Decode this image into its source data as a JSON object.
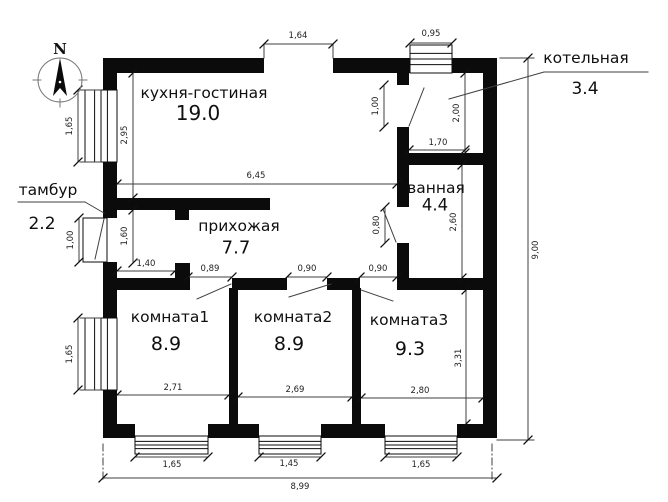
{
  "style": {
    "background": "#ffffff",
    "wall_color": "#0b0b0b",
    "line_color": "#3f3f3f",
    "tick_color": "#111111",
    "text_color": "#1f1f1f"
  },
  "compass": {
    "label": "N",
    "cx": 60,
    "cy": 80,
    "r": 22
  },
  "rooms": [
    {
      "name": "кухня-гостиная",
      "area": "19.0",
      "nx": 204,
      "ny": 93,
      "ax": 198,
      "ay": 113,
      "nfs": 15.5,
      "afs": 20
    },
    {
      "name": "прихожая",
      "area": "7.7",
      "nx": 239,
      "ny": 226,
      "ax": 236,
      "ay": 248,
      "nfs": 15.5,
      "afs": 18
    },
    {
      "name": "ванная",
      "area": "4.4",
      "nx": 436,
      "ny": 188,
      "ax": 435,
      "ay": 205,
      "nfs": 15.5,
      "afs": 16.5
    },
    {
      "name": "комната1",
      "area": "8.9",
      "nx": 170,
      "ny": 317,
      "ax": 166,
      "ay": 344,
      "nfs": 15.5,
      "afs": 19
    },
    {
      "name": "комната2",
      "area": "8.9",
      "nx": 293,
      "ny": 317,
      "ax": 289,
      "ay": 344,
      "nfs": 15.5,
      "afs": 19
    },
    {
      "name": "комната3",
      "area": "9.3",
      "nx": 409,
      "ny": 320,
      "ax": 410,
      "ay": 349,
      "nfs": 15.5,
      "afs": 19
    },
    {
      "name": "котельная",
      "area": "3.4",
      "nx": 586,
      "ny": 58,
      "ax": 585,
      "ay": 89,
      "nfs": 15.5,
      "afs": 17
    },
    {
      "name": "тамбур",
      "area": "2.2",
      "nx": 48,
      "ny": 190,
      "ax": 42,
      "ay": 224,
      "nfs": 15.5,
      "afs": 17
    }
  ],
  "dimensions": [
    {
      "t": "1,64",
      "x1": 264,
      "y1": 44,
      "x2": 333,
      "y2": 44,
      "tx": 298,
      "ty": 36,
      "r": 0
    },
    {
      "t": "0,95",
      "x1": 410,
      "y1": 43,
      "x2": 452,
      "y2": 43,
      "tx": 431,
      "ty": 34,
      "r": 0
    },
    {
      "t": "1,65",
      "x1": 78,
      "y1": 90,
      "x2": 78,
      "y2": 162,
      "tx": 70,
      "ty": 126,
      "r": -90
    },
    {
      "t": "2,95",
      "x1": 133,
      "y1": 73,
      "x2": 133,
      "y2": 198,
      "tx": 125,
      "ty": 135,
      "r": -90
    },
    {
      "t": "6,45",
      "x1": 117,
      "y1": 184,
      "x2": 397,
      "y2": 184,
      "tx": 256,
      "ty": 176,
      "r": 0
    },
    {
      "t": "1,00",
      "x1": 384,
      "y1": 85,
      "x2": 384,
      "y2": 127,
      "tx": 376,
      "ty": 106,
      "r": -90
    },
    {
      "t": "2,00",
      "x1": 465,
      "y1": 73,
      "x2": 465,
      "y2": 153,
      "tx": 457,
      "ty": 113,
      "r": -90
    },
    {
      "t": "1,70",
      "x1": 409,
      "y1": 150,
      "x2": 465,
      "y2": 150,
      "tx": 438,
      "ty": 143,
      "r": 0
    },
    {
      "t": "2,60",
      "x1": 462,
      "y1": 165,
      "x2": 462,
      "y2": 278,
      "tx": 454,
      "ty": 222,
      "r": -90
    },
    {
      "t": "0,80",
      "x1": 385,
      "y1": 207,
      "x2": 385,
      "y2": 243,
      "tx": 377,
      "ty": 225,
      "r": -90
    },
    {
      "t": "1,00",
      "x1": 79,
      "y1": 218,
      "x2": 79,
      "y2": 262,
      "tx": 71,
      "ty": 240,
      "r": -90
    },
    {
      "t": "1,60",
      "x1": 133,
      "y1": 210,
      "x2": 133,
      "y2": 263,
      "tx": 125,
      "ty": 236,
      "r": -90
    },
    {
      "t": "1,40",
      "x1": 117,
      "y1": 271,
      "x2": 175,
      "y2": 271,
      "tx": 146,
      "ty": 264,
      "r": 0
    },
    {
      "t": "0,89",
      "x1": 188,
      "y1": 277,
      "x2": 232,
      "y2": 277,
      "tx": 210,
      "ty": 269,
      "r": 0
    },
    {
      "t": "0,90",
      "x1": 287,
      "y1": 277,
      "x2": 327,
      "y2": 277,
      "tx": 307,
      "ty": 269,
      "r": 0
    },
    {
      "t": "0,90",
      "x1": 360,
      "y1": 277,
      "x2": 397,
      "y2": 277,
      "tx": 378,
      "ty": 269,
      "r": 0
    },
    {
      "t": "2,71",
      "x1": 117,
      "y1": 395,
      "x2": 229,
      "y2": 395,
      "tx": 173,
      "ty": 388,
      "r": 0
    },
    {
      "t": "2,69",
      "x1": 238,
      "y1": 397,
      "x2": 352,
      "y2": 397,
      "tx": 295,
      "ty": 390,
      "r": 0
    },
    {
      "t": "2,80",
      "x1": 361,
      "y1": 398,
      "x2": 483,
      "y2": 398,
      "tx": 420,
      "ty": 391,
      "r": 0
    },
    {
      "t": "3,31",
      "x1": 466,
      "y1": 290,
      "x2": 466,
      "y2": 424,
      "tx": 459,
      "ty": 358,
      "r": -90
    },
    {
      "t": "1,65",
      "x1": 78,
      "y1": 318,
      "x2": 78,
      "y2": 390,
      "tx": 70,
      "ty": 354,
      "r": -90
    },
    {
      "t": "1,65",
      "x1": 135,
      "y1": 457,
      "x2": 208,
      "y2": 457,
      "tx": 172,
      "ty": 465,
      "r": 0
    },
    {
      "t": "1,45",
      "x1": 259,
      "y1": 457,
      "x2": 321,
      "y2": 457,
      "tx": 289,
      "ty": 464,
      "r": 0
    },
    {
      "t": "1,65",
      "x1": 385,
      "y1": 457,
      "x2": 457,
      "y2": 457,
      "tx": 421,
      "ty": 465,
      "r": 0
    },
    {
      "t": "8,99",
      "x1": 103,
      "y1": 478,
      "x2": 497,
      "y2": 478,
      "tx": 300,
      "ty": 487,
      "r": 0
    },
    {
      "t": "9,00",
      "x1": 528,
      "y1": 58,
      "x2": 528,
      "y2": 440,
      "tx": 536,
      "ty": 250,
      "r": -90
    }
  ],
  "plan": {
    "walls": [
      [
        103,
        58,
        161,
        15
      ],
      [
        333,
        58,
        77,
        15
      ],
      [
        452,
        58,
        45,
        15
      ],
      [
        103,
        58,
        14,
        34
      ],
      [
        103,
        162,
        14,
        56
      ],
      [
        103,
        262,
        14,
        56
      ],
      [
        103,
        390,
        14,
        48
      ],
      [
        483,
        58,
        14,
        380
      ],
      [
        103,
        424,
        32,
        14
      ],
      [
        208,
        424,
        51,
        14
      ],
      [
        321,
        424,
        64,
        14
      ],
      [
        457,
        424,
        40,
        14
      ],
      [
        397,
        73,
        12,
        12
      ],
      [
        397,
        127,
        12,
        38
      ],
      [
        397,
        153,
        86,
        12
      ],
      [
        397,
        165,
        12,
        42
      ],
      [
        397,
        243,
        12,
        47
      ],
      [
        397,
        278,
        86,
        12
      ],
      [
        103,
        198,
        167,
        12
      ],
      [
        175,
        210,
        14,
        10
      ],
      [
        175,
        263,
        15,
        27
      ],
      [
        103,
        278,
        85,
        12
      ],
      [
        232,
        278,
        55,
        12
      ],
      [
        327,
        278,
        33,
        12
      ],
      [
        229,
        288,
        9,
        136
      ],
      [
        352,
        288,
        9,
        136
      ]
    ],
    "windows": [
      {
        "x": 85,
        "y": 90,
        "w": 32,
        "h": 72,
        "o": "v"
      },
      {
        "x": 85,
        "y": 318,
        "w": 32,
        "h": 72,
        "o": "v"
      },
      {
        "x": 410,
        "y": 45,
        "w": 42,
        "h": 28,
        "o": "h"
      },
      {
        "x": 135,
        "y": 436,
        "w": 73,
        "h": 18,
        "o": "h"
      },
      {
        "x": 259,
        "y": 436,
        "w": 62,
        "h": 18,
        "o": "h"
      },
      {
        "x": 385,
        "y": 436,
        "w": 72,
        "h": 18,
        "o": "h"
      }
    ],
    "boxes": [
      [
        83,
        218,
        24,
        44
      ]
    ],
    "lines": [
      [
        264,
        44,
        264,
        58,
        "s",
        "extension-line"
      ],
      [
        333,
        44,
        333,
        58,
        "s",
        "extension-line"
      ],
      [
        80,
        90,
        101,
        90,
        "s",
        "extension-line"
      ],
      [
        80,
        162,
        101,
        162,
        "s",
        "extension-line"
      ],
      [
        80,
        318,
        101,
        318,
        "s",
        "extension-line"
      ],
      [
        80,
        390,
        101,
        390,
        "s",
        "extension-line"
      ],
      [
        500,
        58,
        534,
        58,
        "s",
        "extension-line"
      ],
      [
        497,
        440,
        534,
        440,
        "s",
        "extension-line"
      ],
      [
        103,
        444,
        103,
        480,
        "d",
        "extension-line"
      ],
      [
        492,
        444,
        492,
        480,
        "d",
        "extension-line"
      ],
      [
        18,
        202,
        85,
        202,
        "s",
        "leader-line-vestibule"
      ],
      [
        85,
        202,
        104,
        213,
        "s",
        "leader-line-vestibule"
      ],
      [
        449,
        99,
        544,
        72,
        "s",
        "leader-line-boiler"
      ],
      [
        544,
        72,
        648,
        72,
        "s",
        "leader-line-boiler"
      ],
      [
        104,
        219,
        95,
        259,
        "s",
        "door-leaf"
      ],
      [
        409,
        126,
        424,
        88,
        "s",
        "door-leaf"
      ],
      [
        396,
        242,
        383,
        209,
        "s",
        "door-leaf"
      ],
      [
        197,
        299,
        231,
        284,
        "s",
        "door-leaf"
      ],
      [
        289,
        297,
        331,
        284,
        "s",
        "door-leaf"
      ],
      [
        361,
        290,
        393,
        301,
        "s",
        "door-leaf"
      ]
    ]
  }
}
